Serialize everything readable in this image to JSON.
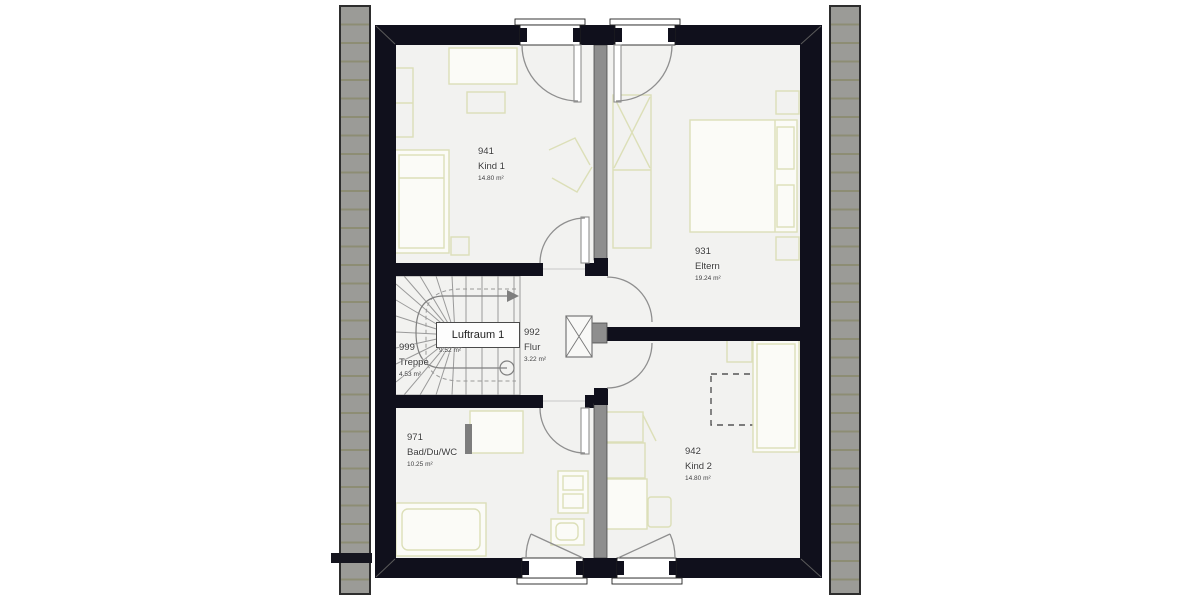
{
  "title": "Dachgeschoss Grundriss",
  "colors": {
    "wall": "#10101c",
    "floor": "#f2f2f0",
    "roof": "#9b9b97",
    "roofline": "#8d8d74",
    "furniture": "#dcdfb8",
    "door": "#8f8f8f",
    "text": "#3a3a3a"
  },
  "rooms": [
    {
      "number": "941",
      "name": "Kind 1",
      "area": "14.80 m²"
    },
    {
      "number": "931",
      "name": "Eltern",
      "area": "19.24 m²"
    },
    {
      "number": "999",
      "name": "Treppe",
      "area": "4.53 m²"
    },
    {
      "number": "992",
      "name": "Flur",
      "area": "3.22 m²"
    },
    {
      "number": "971",
      "name": "Bad/Du/WC",
      "area": "10.25 m²"
    },
    {
      "number": "942",
      "name": "Kind 2",
      "area": "14.80 m²"
    }
  ],
  "void_label": {
    "name": "Luftraum 1",
    "area": "9.52 m²"
  }
}
